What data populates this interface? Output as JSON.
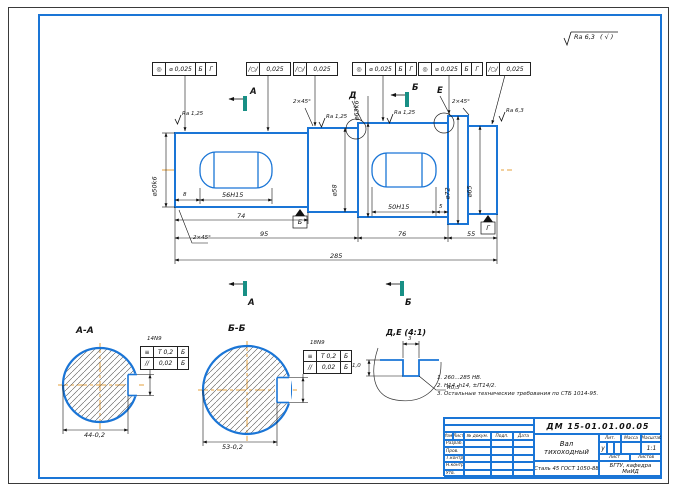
{
  "drawing": {
    "general_roughness": {
      "value": "Ra 6,3",
      "alt": "( √ )"
    },
    "tolerance_frames": [
      {
        "sym": "◎",
        "val": "⌀ 0,025",
        "d1": "Б",
        "d2": "Г"
      },
      {
        "sym": "/○/",
        "val": "0,025"
      },
      {
        "sym": "/○/",
        "val": "0,025"
      },
      {
        "sym": "◎",
        "val": "⌀ 0,025",
        "d1": "Б",
        "d2": "Г"
      },
      {
        "sym": "◎",
        "val": "⌀ 0,025",
        "d1": "Б",
        "d2": "Г"
      },
      {
        "sym": "/○/",
        "val": "0,025"
      }
    ],
    "marks": {
      "sec_a": "А",
      "sec_b": "Б",
      "det_d": "Д",
      "det_e": "Е",
      "datum_b": "Б",
      "datum_g": "Г"
    },
    "roughness": {
      "r1": "Ra 1,25",
      "r2": "Ra 1,25",
      "r3": "Ra 1,25",
      "r4": "Ra 6,3"
    },
    "dims": {
      "kw1": "56H15",
      "kw1_off": "8",
      "kw2": "50H15",
      "kw2_off": "5",
      "len1": "74",
      "len2": "95",
      "len3": "76",
      "len4": "55",
      "total": "285",
      "cham_bl": "2×45°",
      "cham_t1": "2×45°",
      "cham_t2": "2×45°",
      "d1": "⌀50k6",
      "d2": "⌀58",
      "d3": "⌀63k6",
      "d4": "⌀72",
      "d5": "⌀65"
    },
    "section_aa": {
      "title": "А-А",
      "width": "14N9",
      "dia": "44-0,2",
      "f1": {
        "sym": "≡",
        "val": "T 0,2",
        "d": "Б"
      },
      "f2": {
        "sym": "//",
        "val": "0,02",
        "d": "Б"
      }
    },
    "section_bb": {
      "title": "Б-Б",
      "width": "18N9",
      "dia": "53-0,2",
      "f1": {
        "sym": "≡",
        "val": "T 0,2",
        "d": "Б"
      },
      "f2": {
        "sym": "//",
        "val": "0,02",
        "d": "Б"
      }
    },
    "detail": {
      "title": "Д,Е (4:1)",
      "w": "3",
      "dep": "1,0",
      "rad": "R0,5"
    },
    "notes": {
      "n1": "1. 260...285 НВ.",
      "n2": "2. Н14, h14, ±IT14/2.",
      "n3": "3. Остальные технические требования по СТБ 1014-95."
    },
    "tb": {
      "doc": "ДМ 15-01.01.00.05",
      "name_l1": "Вал",
      "name_l2": "тихоходный",
      "material": "Сталь 45 ГОСТ 1050-88",
      "h_izm": "Изм.",
      "h_list": "Лист",
      "h_doc": "№ докум.",
      "h_podp": "Подп.",
      "h_data": "Дата",
      "r1": "Разраб.",
      "r2": "Пров.",
      "r3": "Т.контр.",
      "r4": "Н.контр.",
      "r5": "Утв.",
      "lit": "Лит.",
      "lit_val": "у",
      "massa": "Масса",
      "scale": "Масштаб",
      "scale_val": "1:1",
      "sheet": "Лист",
      "sheets": "Листов",
      "org_l1": "БГТУ, кафедра",
      "org_l2": "МиИД"
    }
  }
}
